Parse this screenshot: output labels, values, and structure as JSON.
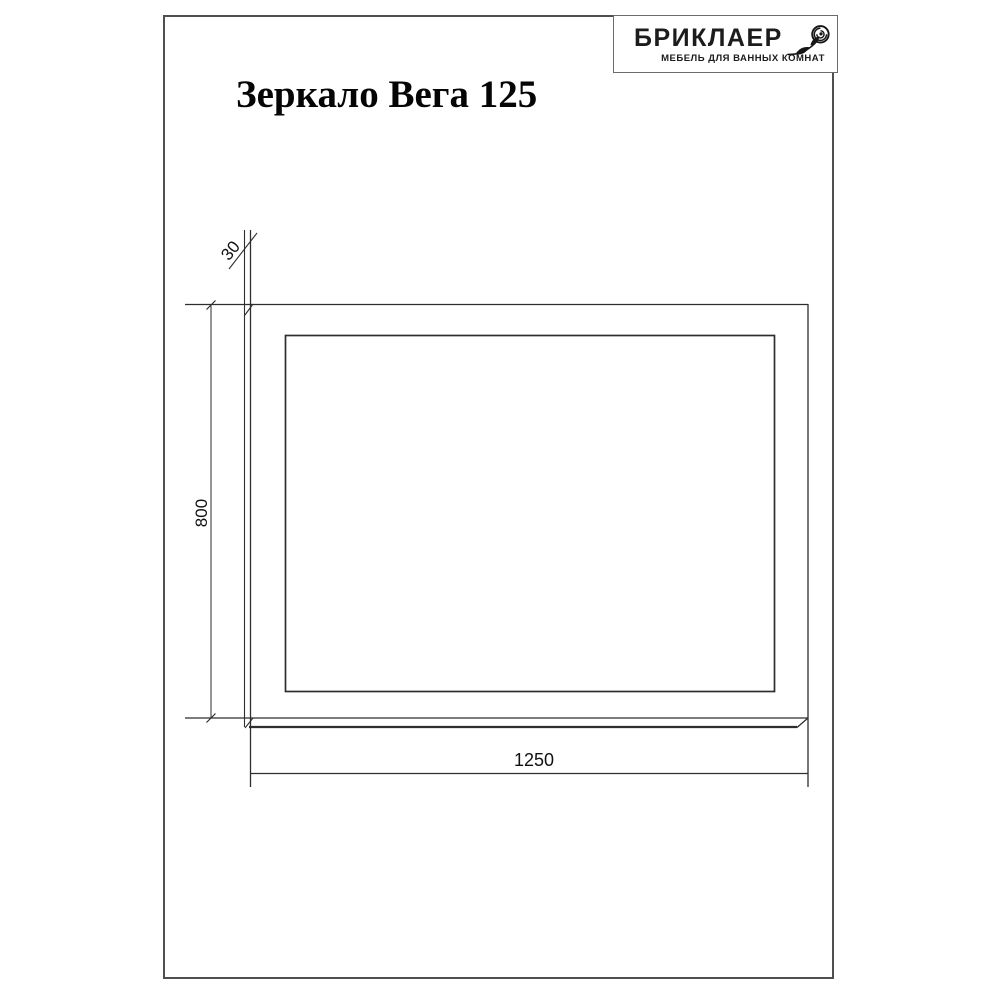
{
  "page": {
    "title": "Зеркало Вега 125"
  },
  "logo": {
    "brand": "БРИКЛАЕР",
    "tagline": "МЕБЕЛЬ ДЛЯ ВАННЫХ КОМНАТ",
    "icon": "rose-icon"
  },
  "drawing": {
    "view": "mirror front view with depth edge",
    "labels": {
      "width": "1250",
      "height": "800",
      "depth": "30"
    }
  },
  "colors": {
    "background": "#ffffff",
    "line": "#2e2e2e",
    "page_border": "#4f4f4f",
    "text": "#000000"
  }
}
